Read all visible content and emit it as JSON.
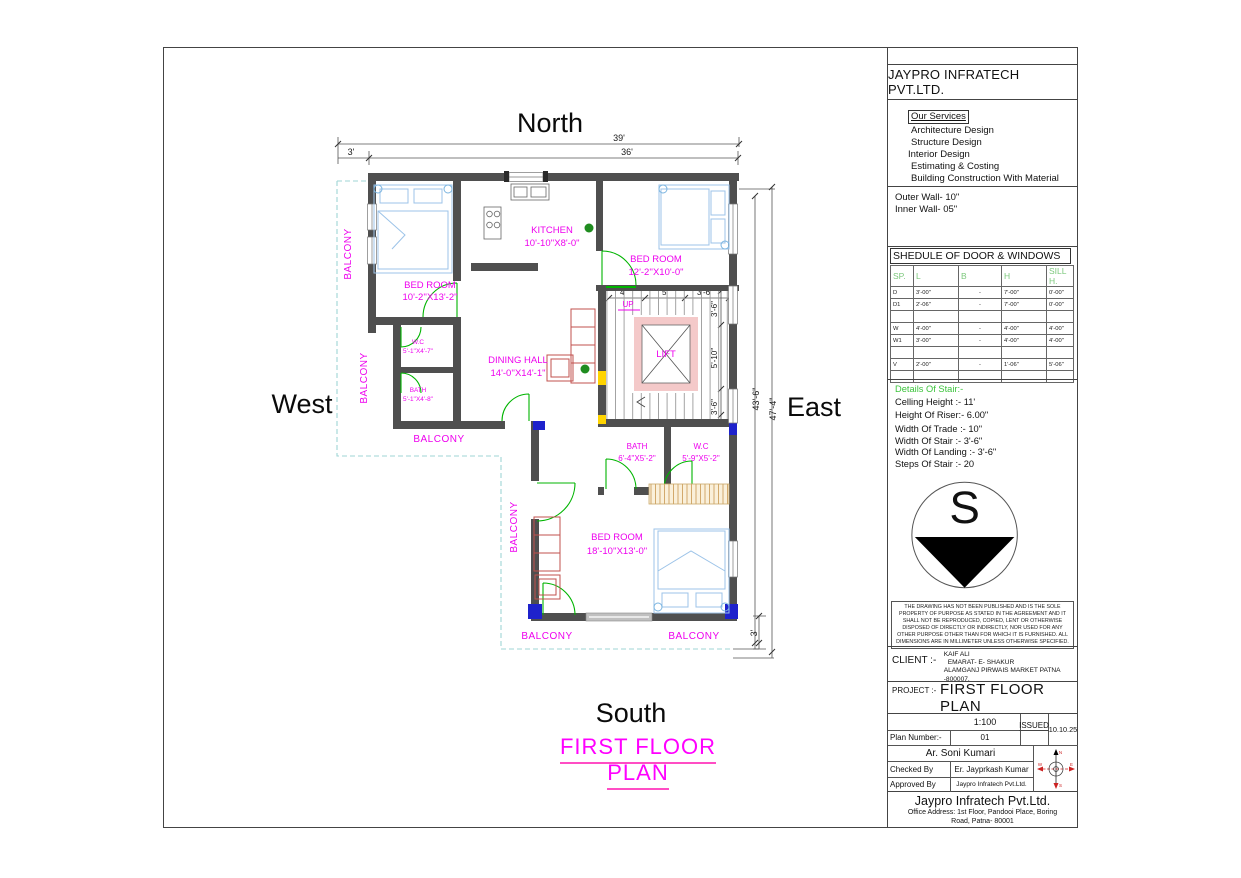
{
  "orientation": {
    "north": "North",
    "south": "South",
    "east": "East",
    "west": "West"
  },
  "plan": {
    "title": "FIRST FLOOR PLAN",
    "balcony_label": "BALCONY",
    "rooms": [
      {
        "name": "BED ROOM",
        "size": "10'-2''X13'-2\""
      },
      {
        "name": "KITCHEN",
        "size": "10'-10''X8'-0\""
      },
      {
        "name": "BED ROOM",
        "size": "12'-2''X10'-0\""
      },
      {
        "name": "W.C",
        "size": "5'-1''X4'-7\""
      },
      {
        "name": "BATH",
        "size": "5'-1''X4'-8\""
      },
      {
        "name": "DINING HALL",
        "size": "14'-0''X14'-1\""
      },
      {
        "name": "BATH",
        "size": "6'-4''X5'-2\""
      },
      {
        "name": "W.C",
        "size": "5'-9''X5'-2\""
      },
      {
        "name": "BED ROOM",
        "size": "18'-10''X13'-0\""
      }
    ],
    "stair": {
      "up": "UP",
      "lift": "LIFT",
      "lift_w": "4'-2\"",
      "lift_h": "4'-2\""
    },
    "dims": {
      "top_total": "39'",
      "top_inner": "36'",
      "top_left": "3'",
      "right_inner": "43'-6\"",
      "right_outer": "47'-4\"",
      "bottom_right": "3'",
      "stair_a": "4'",
      "stair_b": "5'",
      "stair_c": "3'-6\"",
      "stair_r1": "3'-6\"",
      "stair_r2": "5'-10\"",
      "stair_r3": "3'-6\""
    }
  },
  "title_block": {
    "company": "JAYPRO INFRATECH PVT.LTD.",
    "services": {
      "heading": "Our Services",
      "items": [
        "Architecture Design",
        "Structure Design",
        "Interior Design",
        "Estimating & Costing",
        "Building Construction With Material"
      ]
    },
    "walls": {
      "outer": "Outer Wall- 10\"",
      "inner": "Inner  Wall- 05\""
    },
    "schedule": {
      "title": "SHEDULE OF DOOR & WINDOWS",
      "headers": [
        "SP.",
        "L",
        "B",
        "H",
        "SILL H."
      ],
      "rows": [
        [
          "D",
          "3'-00\"",
          "-",
          "7'-00\"",
          "0'-00\""
        ],
        [
          "D1",
          "2'-06\"",
          "-",
          "7'-00\"",
          "0'-00\""
        ],
        [
          "",
          "",
          "",
          "",
          ""
        ],
        [
          "W",
          "4'-00\"",
          "-",
          "4'-00\"",
          "4'-00\""
        ],
        [
          "W1",
          "3'-00\"",
          "-",
          "4'-00\"",
          "4'-00\""
        ],
        [
          "",
          "",
          "",
          "",
          ""
        ],
        [
          "V",
          "2'-00\"",
          "-",
          "1'-06\"",
          "5'-06\""
        ],
        [
          "",
          "",
          "",
          "",
          ""
        ]
      ]
    },
    "stair_details": {
      "title": "Details Of Stair:-",
      "lines": [
        "Celling Height :- 11'",
        "Height Of Riser:- 6.00\"",
        "Width Of Trade :- 10\"",
        "Width Of Stair :- 3'-6\"",
        "Width Of Landing :- 3'-6\"",
        "Steps Of Stair :- 20"
      ]
    },
    "compass_letter": "S",
    "disclaimer": "THE DRAWING HAS NOT BEEN PUBLISHED AND IS THE SOLE PROPERTY OF PURPOSE AS STATED IN THE AGREEMENT AND IT SHALL NOT BE REPRODUCED, COPIED, LENT OR OTHERWISE DISPOSED OF DIRECTLY OR INDIRECTLY, NOR USED FOR ANY OTHER PURPOSE OTHER THAN FOR WHICH IT IS FURNISHED. ALL DIMENSIONS ARE IN MILLIMETER UNLESS OTHERWISE SPECIFIED.",
    "client": {
      "label": "CLIENT :-",
      "lines": [
        "KAIF ALI",
        "EMARAT- E- SHAKUR",
        "ALAMGANJ  PIRWAIS MARKET PATNA -800007."
      ]
    },
    "project": {
      "label": "PROJECT :-",
      "name": "FIRST FLOOR PLAN"
    },
    "approval": {
      "scale": "1:100",
      "issued_label": "ISSUED",
      "issued_date": "10.10.25",
      "plan_number_label": "Plan Number:-",
      "plan_number": "01",
      "drawn_by": "Ar. Soni Kumari",
      "checked_label": "Checked By",
      "checked_by": "Er. Jayprkash Kumar",
      "approved_label": "Approved By",
      "approved_by": "Jaypro Infratech Pvt.Ltd."
    },
    "footer": {
      "company": "Jaypro Infratech Pvt.Ltd.",
      "address": "Office Address: 1st Floor, Pandooi Place, Boring Road, Patna- 80001"
    }
  }
}
